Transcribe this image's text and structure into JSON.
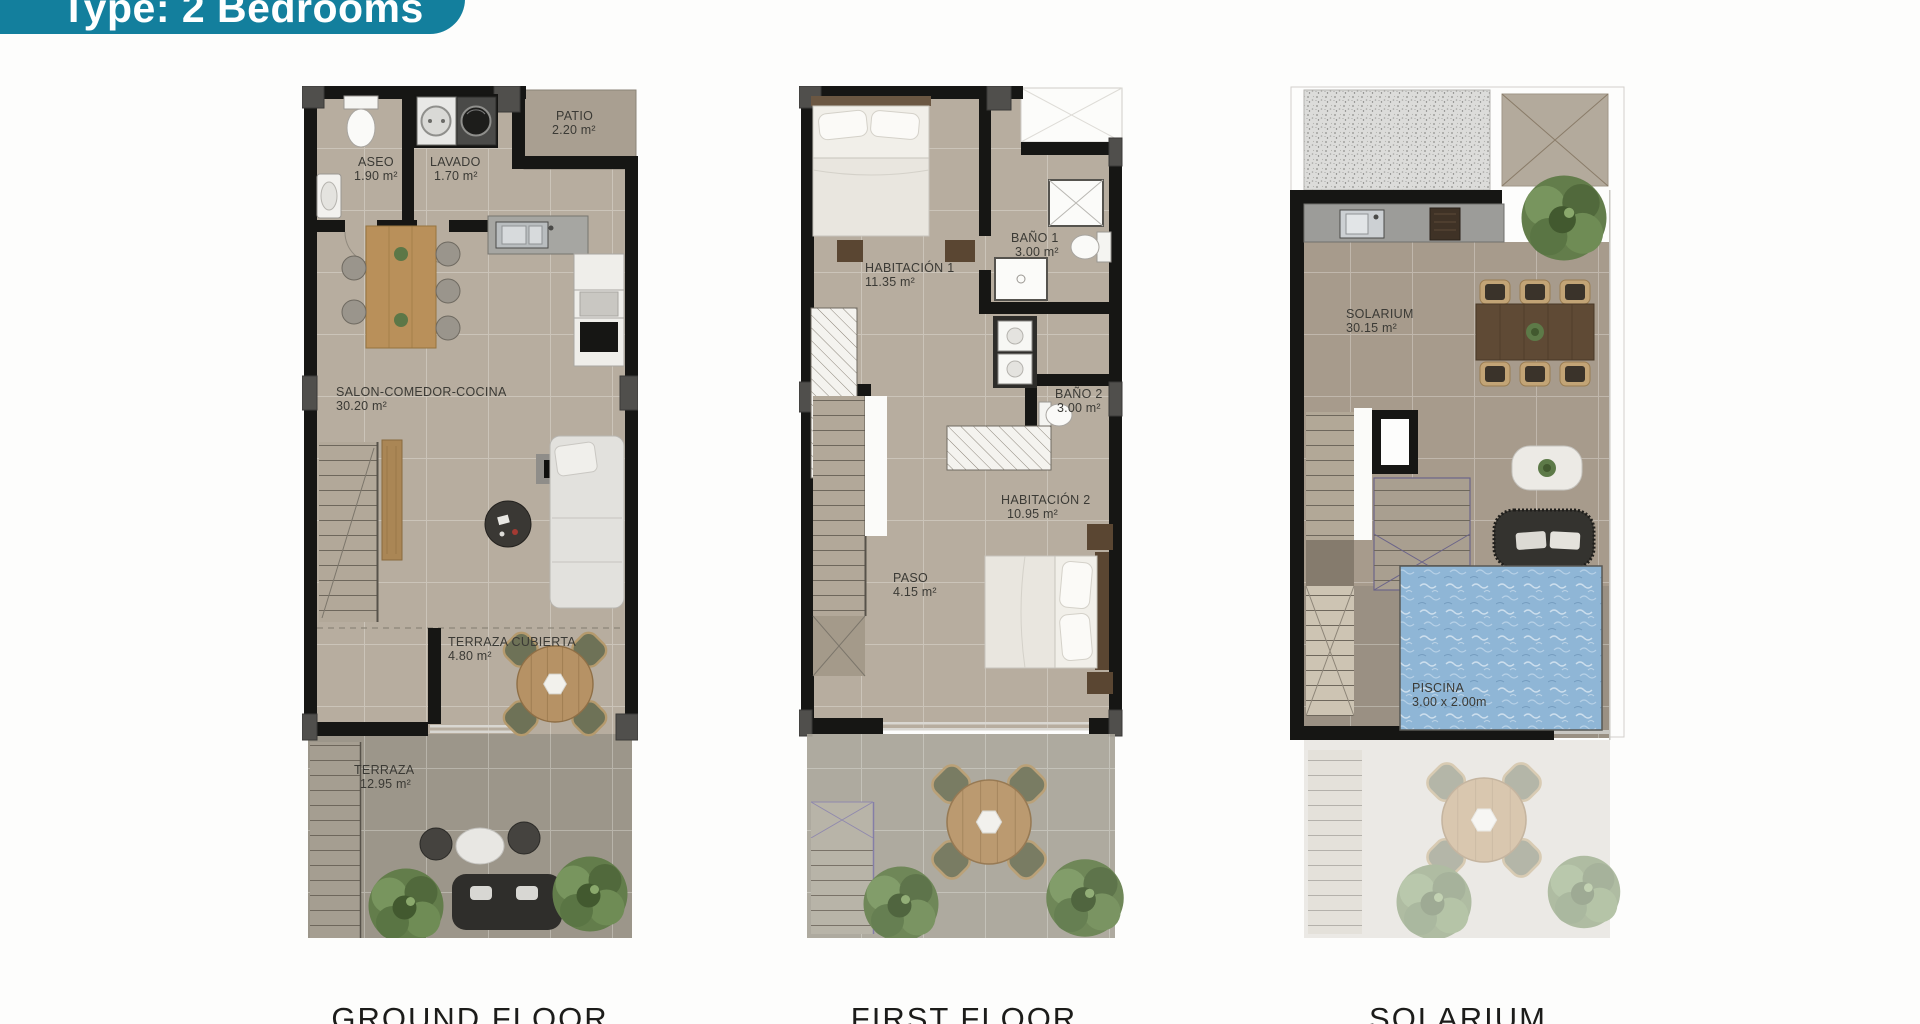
{
  "badge": {
    "label": "Type: 2 Bedrooms"
  },
  "plans": [
    {
      "id": "ground-floor",
      "caption": "GROUND FLOOR",
      "rooms": [
        {
          "name": "ASEO",
          "area": "1.90 m²"
        },
        {
          "name": "LAVADO",
          "area": "1.70 m²"
        },
        {
          "name": "PATIO",
          "area": "2.20 m²"
        },
        {
          "name": "SALON-COMEDOR-COCINA",
          "area": "30.20 m²"
        },
        {
          "name": "TERRAZA CUBIERTA",
          "area": "4.80 m²"
        },
        {
          "name": "TERRAZA",
          "area": "12.95 m²"
        }
      ]
    },
    {
      "id": "first-floor",
      "caption": "FIRST FLOOR",
      "rooms": [
        {
          "name": "HABITACIÓN 1",
          "area": "11.35 m²"
        },
        {
          "name": "BAÑO 1",
          "area": "3.00 m²"
        },
        {
          "name": "BAÑO 2",
          "area": "3.00 m²"
        },
        {
          "name": "HABITACIÓN 2",
          "area": "10.95 m²"
        },
        {
          "name": "PASO",
          "area": "4.15 m²"
        }
      ]
    },
    {
      "id": "solarium",
      "caption": "SOLARIUM",
      "rooms": [
        {
          "name": "SOLARIUM",
          "area": "30.15 m²"
        },
        {
          "name": "PISCINA",
          "area": "3.00 x 2.00m"
        }
      ]
    }
  ],
  "colors": {
    "badge_bg": "#137f9d",
    "badge_text": "#ffffff",
    "floor_tan": "#b7ad9f",
    "terrace_gray": "#9c968a",
    "wall_black": "#161614",
    "pool_blue": "#8fb6d6",
    "plant_green": "#5f7a49",
    "caption_text": "#1c1c1a"
  }
}
